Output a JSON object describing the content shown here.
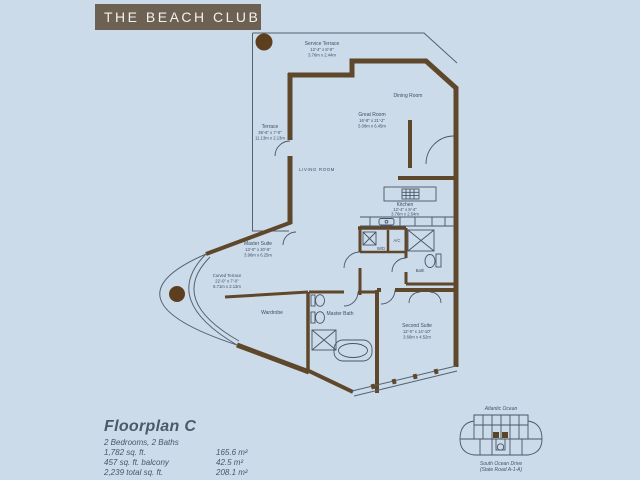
{
  "title": "THE BEACH CLUB",
  "colors": {
    "background": "#ccdbea",
    "titlebar": "#6c6153",
    "walls": "#5e472a",
    "accent_circle": "#5d3f20",
    "label_text": "#3d4f63"
  },
  "rooms": {
    "service_terrace": {
      "name": "Service Terrace",
      "dims_ft": "12'-4\" x 8'-0\"",
      "dims_m": "3.76m x 2.44m"
    },
    "terrace": {
      "name": "Terrace",
      "dims_ft": "36'-6\" x 7'-0\"",
      "dims_m": "11.13m x 2.13m"
    },
    "dining_room": {
      "name": "Dining Room"
    },
    "great_room": {
      "name": "Great Room",
      "dims_ft": "16'-8\" x 21'-2\"",
      "dims_m": "5.08m x 6.45m"
    },
    "living_room": {
      "name": "LIVING ROOM"
    },
    "kitchen": {
      "name": "Kitchen",
      "dims_ft": "12'-4\" x 8'-4\"",
      "dims_m": "3.76m x 2.54m"
    },
    "master_suite": {
      "name": "Master Suite",
      "dims_ft": "13'-0\" x 20'-6\"",
      "dims_m": "3.96m x 6.25m"
    },
    "curved_terrace": {
      "name": "Curved Terrace",
      "dims_ft": "22'-0\" x 7'-0\"",
      "dims_m": "6.71m x 2.13m"
    },
    "wardrobe": {
      "name": "Wardrobe"
    },
    "master_bath": {
      "name": "Master Bath"
    },
    "second_suite": {
      "name": "Second Suite",
      "dims_ft": "12'-0\" x 14'-10\"",
      "dims_m": "3.66m x 4.52m"
    },
    "bath": {
      "name": "Bath"
    },
    "ac_closet": {
      "name": "A/C"
    },
    "wd_closet": {
      "name": "W/D"
    }
  },
  "summary": {
    "plan_name": "Floorplan C",
    "configuration": "2 Bedrooms, 2 Baths",
    "areas": [
      {
        "imperial": "1,782 sq. ft.",
        "metric": "165.6 m²"
      },
      {
        "imperial": "457 sq. ft. balcony",
        "metric": "42.5 m²"
      },
      {
        "imperial": "2,239 total sq. ft.",
        "metric": "208.1 m²"
      }
    ]
  },
  "keyplan": {
    "ocean_label": "Atlantic Ocean",
    "street_label": "South Ocean Drive",
    "street_label2": "(State Road A-1-A)"
  }
}
